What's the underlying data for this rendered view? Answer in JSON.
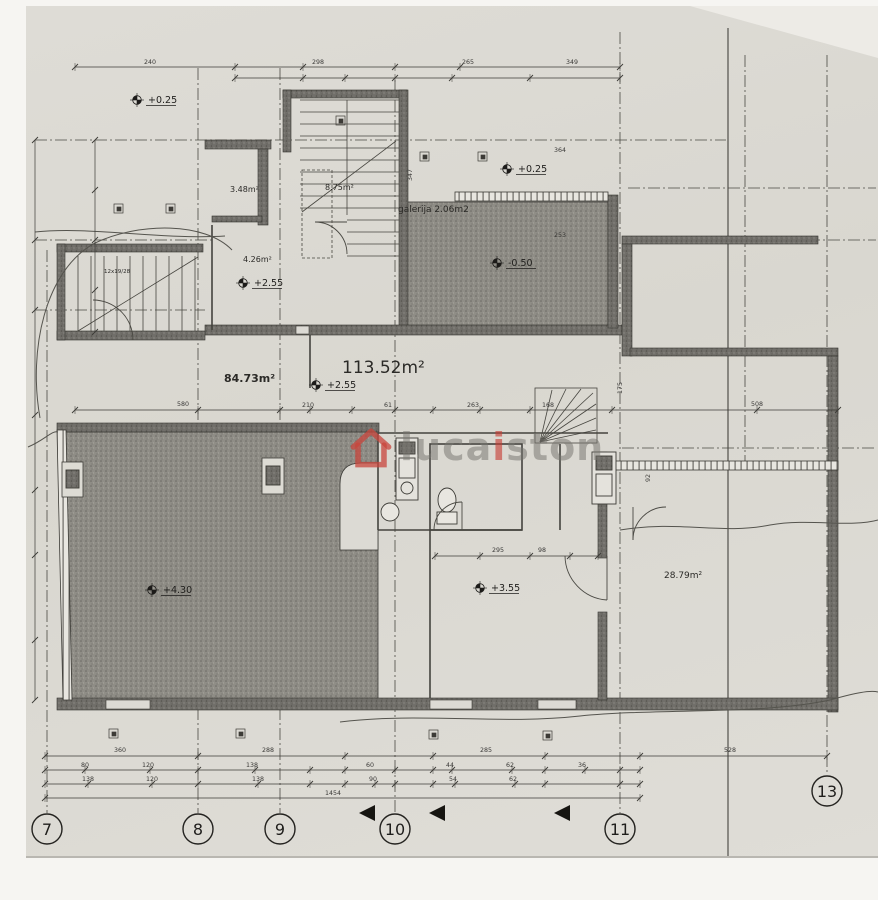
{
  "watermark": {
    "brand_prefix": "luca",
    "brand_accent": "i",
    "brand_suffix": "ston",
    "accent_color": "#c8463c",
    "text_color": "#787672"
  },
  "areas": [
    {
      "id": "room-3-48",
      "text": "3.48m²",
      "x": 230,
      "y": 192,
      "size": 8
    },
    {
      "id": "room-8-75",
      "text": "8.75m²",
      "x": 325,
      "y": 190,
      "size": 8
    },
    {
      "id": "room-4-26",
      "text": "4.26m²",
      "x": 243,
      "y": 262,
      "size": 8
    },
    {
      "id": "galerija",
      "text": "galerija 2.06m2",
      "x": 398,
      "y": 212,
      "size": 9
    },
    {
      "id": "room-113-52",
      "text": "113.52m²",
      "x": 342,
      "y": 373,
      "size": 17
    },
    {
      "id": "room-84-73",
      "text": "84.73m²",
      "x": 224,
      "y": 382,
      "size": 11,
      "bold": true
    },
    {
      "id": "room-28-79",
      "text": "28.79m²",
      "x": 664,
      "y": 578,
      "size": 9
    },
    {
      "id": "stair-note",
      "text": "12x19/28",
      "x": 104,
      "y": 273,
      "size": 5.5
    }
  ],
  "elevations": [
    {
      "text": "+0.25",
      "x": 148,
      "y": 103
    },
    {
      "text": "+0.25",
      "x": 518,
      "y": 172
    },
    {
      "text": "-0.50",
      "x": 508,
      "y": 266
    },
    {
      "text": "+2.55",
      "x": 254,
      "y": 286
    },
    {
      "text": "+2.55",
      "x": 327,
      "y": 388
    },
    {
      "text": "+4.30",
      "x": 163,
      "y": 593
    },
    {
      "text": "+3.55",
      "x": 491,
      "y": 591
    }
  ],
  "grid_bubbles": [
    {
      "label": "7",
      "x": 47,
      "y": 829
    },
    {
      "label": "8",
      "x": 198,
      "y": 829
    },
    {
      "label": "9",
      "x": 280,
      "y": 829
    },
    {
      "label": "10",
      "x": 395,
      "y": 829
    },
    {
      "label": "11",
      "x": 620,
      "y": 829
    },
    {
      "label": "13",
      "x": 827,
      "y": 791
    }
  ],
  "dims": [
    {
      "t": "240",
      "x": 150,
      "y": 64
    },
    {
      "t": "298",
      "x": 318,
      "y": 64
    },
    {
      "t": "265",
      "x": 468,
      "y": 64
    },
    {
      "t": "349",
      "x": 572,
      "y": 64
    },
    {
      "t": "364",
      "x": 560,
      "y": 152
    },
    {
      "t": "253",
      "x": 560,
      "y": 237
    },
    {
      "t": "580",
      "x": 183,
      "y": 406
    },
    {
      "t": "210",
      "x": 308,
      "y": 407
    },
    {
      "t": "61",
      "x": 388,
      "y": 407
    },
    {
      "t": "263",
      "x": 473,
      "y": 407
    },
    {
      "t": "168",
      "x": 548,
      "y": 407
    },
    {
      "t": "508",
      "x": 757,
      "y": 406
    },
    {
      "t": "295",
      "x": 498,
      "y": 552
    },
    {
      "t": "98",
      "x": 542,
      "y": 552
    },
    {
      "t": "360",
      "x": 120,
      "y": 752
    },
    {
      "t": "288",
      "x": 268,
      "y": 752
    },
    {
      "t": "285",
      "x": 486,
      "y": 752
    },
    {
      "t": "528",
      "x": 730,
      "y": 752
    },
    {
      "t": "80",
      "x": 85,
      "y": 767
    },
    {
      "t": "120",
      "x": 148,
      "y": 767
    },
    {
      "t": "138",
      "x": 252,
      "y": 767
    },
    {
      "t": "60",
      "x": 370,
      "y": 767
    },
    {
      "t": "44",
      "x": 450,
      "y": 767
    },
    {
      "t": "62",
      "x": 510,
      "y": 767
    },
    {
      "t": "36",
      "x": 582,
      "y": 767
    },
    {
      "t": "138",
      "x": 88,
      "y": 781
    },
    {
      "t": "120",
      "x": 152,
      "y": 781
    },
    {
      "t": "138",
      "x": 258,
      "y": 781
    },
    {
      "t": "90",
      "x": 373,
      "y": 781
    },
    {
      "t": "54",
      "x": 453,
      "y": 781
    },
    {
      "t": "62",
      "x": 513,
      "y": 781
    },
    {
      "t": "1454",
      "x": 333,
      "y": 795
    },
    {
      "t": "347",
      "x": 412,
      "y": 175,
      "r": 1
    },
    {
      "t": "175",
      "x": 622,
      "y": 388,
      "r": 1
    },
    {
      "t": "92",
      "x": 650,
      "y": 478,
      "r": 1
    }
  ]
}
